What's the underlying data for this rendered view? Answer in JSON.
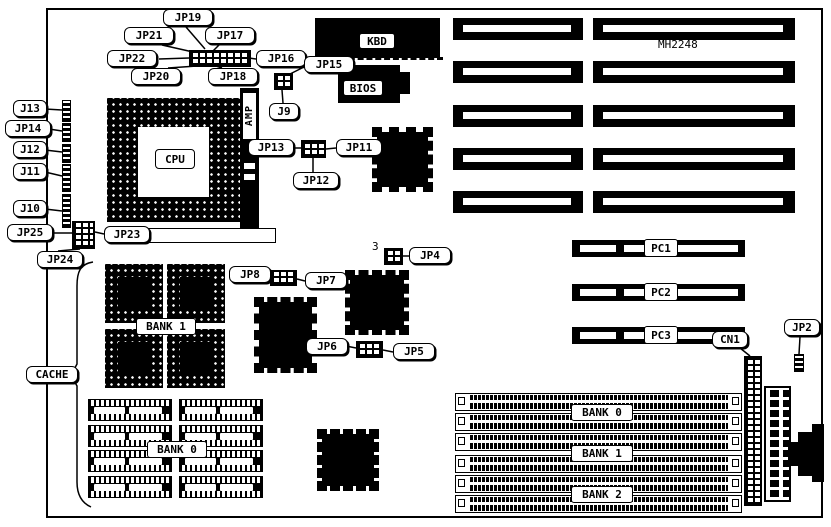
{
  "diagram": {
    "title": "Motherboard jumper and connector location diagram",
    "board_silkscreen": "MH2248",
    "callouts": {
      "jp19": "JP19",
      "jp21": "JP21",
      "jp17": "JP17",
      "jp22": "JP22",
      "jp16": "JP16",
      "jp20": "JP20",
      "jp18": "JP18",
      "jp15": "JP15",
      "j9": "J9",
      "j13": "J13",
      "jp14": "JP14",
      "j12": "J12",
      "j11": "J11",
      "j10": "J10",
      "jp25": "JP25",
      "jp23": "JP23",
      "jp24": "JP24",
      "jp13": "JP13",
      "jp12": "JP12",
      "jp11": "JP11",
      "jp8": "JP8",
      "jp7": "JP7",
      "jp4": "JP4",
      "jp6": "JP6",
      "jp5": "JP5",
      "cache": "CACHE",
      "cn1": "CN1",
      "jp2": "JP2"
    },
    "chip_labels": {
      "cpu": "CPU",
      "kbd": "KBD",
      "bios": "BIOS",
      "amp": "AMP"
    },
    "cache_bank_labels": {
      "bank1": "BANK 1",
      "bank0": "BANK 0"
    },
    "pci_slot_labels": [
      "PC1",
      "PC2",
      "PC3"
    ],
    "simm_bank_labels": [
      "BANK 0",
      "BANK 1",
      "BANK 2"
    ],
    "jp4_pin_label": "3",
    "colors": {
      "ink": "#000000",
      "paper": "#ffffff"
    }
  }
}
